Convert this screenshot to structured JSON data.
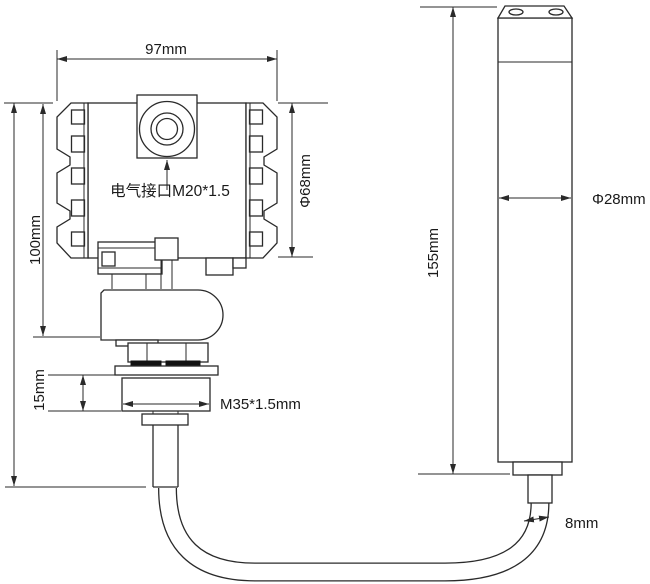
{
  "diagram": {
    "type": "technical-dimension-drawing",
    "subject": "transmitter with cable-connected sensor probe",
    "colors": {
      "line": "#2a2a2a",
      "text": "#1a1a1a",
      "background": "#ffffff",
      "gasket": "#111111"
    },
    "transmitter": {
      "width_label": "97mm",
      "height_label": "100mm",
      "housing_diameter_label": "Φ68mm",
      "electrical_interface_label": "电气接口M20*1.5",
      "flange_height_label": "15mm",
      "process_thread_label": "M35*1.5mm"
    },
    "probe": {
      "length_label": "155mm",
      "diameter_label": "Φ28mm",
      "cable_diameter_label": "8mm"
    }
  }
}
